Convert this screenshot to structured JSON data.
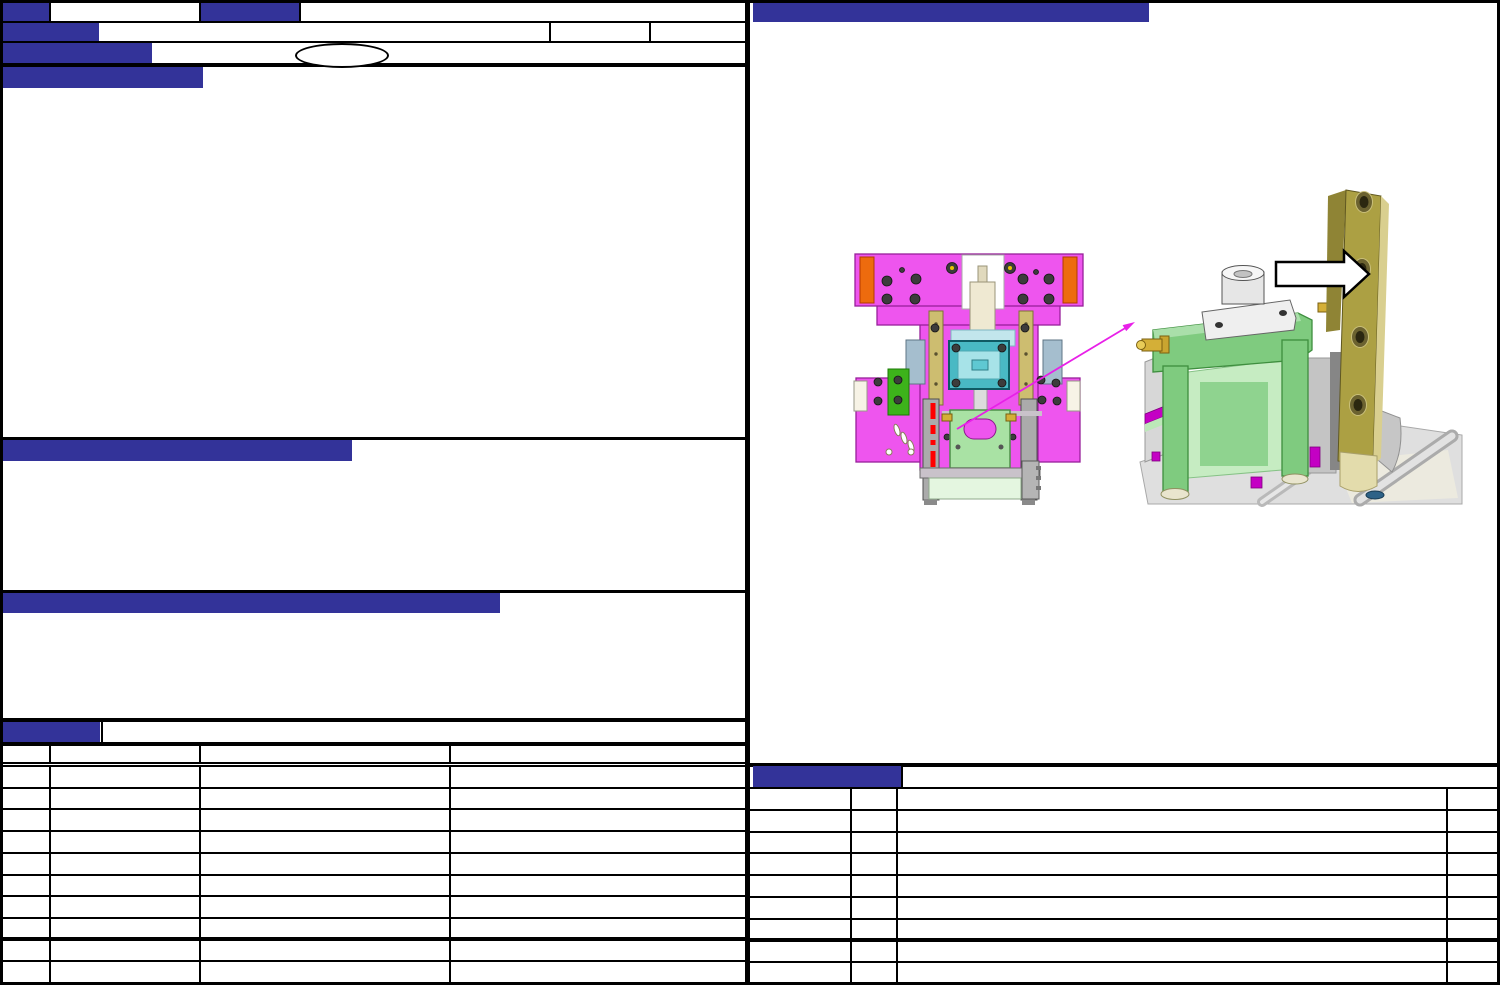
{
  "colors": {
    "accent": "#333399",
    "line": "#000000",
    "bg": "#ffffff",
    "fig-pink": "#ee55ee",
    "fig-orange": "#ed6b0e",
    "fig-tan": "#cdbd70",
    "fig-cyan": "#49b9c4",
    "fig-cyan-light": "#a7e3e8",
    "fig-green-bright": "#3db31b",
    "fig-green": "#7fcb7f",
    "fig-green-light": "#a9e2a4",
    "fig-green-pale": "#e4f6e0",
    "fig-khaki": "#aca043",
    "fig-khaki-light": "#d9cf8f",
    "fig-khaki-dark": "#8f8435",
    "fig-gray": "#ababab",
    "fig-base-gray": "#dfdfdf",
    "fig-ivory": "#efe9d2",
    "fig-gold": "#d4af37",
    "fig-red": "#ff0000",
    "fig-magenta": "#c400c4",
    "fig-leader": "#e820e8",
    "fig-hole-blue": "#2e6287"
  },
  "header": {
    "badge_row1_left": "",
    "cell_row1_a": "",
    "badge_row1_mid": "",
    "cell_row1_b": "",
    "badge_row2": "",
    "cell_row2_a": "",
    "cell_row2_b": "",
    "cell_row2_c": "",
    "badge_row3": "",
    "cell_row3": "",
    "oval_label": "",
    "section1_title": ""
  },
  "sections": {
    "section1_content": "",
    "section2_title": "",
    "section2_content": "",
    "section3_title": "",
    "section3_content": ""
  },
  "left_table": {
    "title_badge": "",
    "title": "",
    "columns": [
      "",
      "",
      "",
      ""
    ],
    "rows": [
      [
        "",
        "",
        "",
        ""
      ],
      [
        "",
        "",
        "",
        ""
      ],
      [
        "",
        "",
        "",
        ""
      ],
      [
        "",
        "",
        "",
        ""
      ],
      [
        "",
        "",
        "",
        ""
      ],
      [
        "",
        "",
        "",
        ""
      ],
      [
        "",
        "",
        "",
        ""
      ],
      [
        "",
        "",
        "",
        ""
      ],
      [
        "",
        "",
        "",
        ""
      ],
      [
        "",
        "",
        "",
        ""
      ]
    ]
  },
  "right_panel": {
    "top_bar_title": ""
  },
  "right_table": {
    "title_badge": "",
    "title": "",
    "columns": [
      "",
      "",
      "",
      ""
    ],
    "rows": [
      [
        "",
        "",
        "",
        ""
      ],
      [
        "",
        "",
        "",
        ""
      ],
      [
        "",
        "",
        "",
        ""
      ],
      [
        "",
        "",
        "",
        ""
      ],
      [
        "",
        "",
        "",
        ""
      ],
      [
        "",
        "",
        "",
        ""
      ],
      [
        "",
        "",
        "",
        ""
      ],
      [
        "",
        "",
        "",
        ""
      ]
    ]
  },
  "figures": {
    "overview_view": {
      "name": "mold-assembly-front-view",
      "parts": [
        {
          "name": "mold-plate",
          "color": "#ee55ee"
        },
        {
          "name": "corner-wear-strips",
          "color": "#ed6b0e"
        },
        {
          "name": "guide-bars",
          "color": "#cdbd70"
        },
        {
          "name": "center-cavity-block",
          "color": "#49b9c4"
        },
        {
          "name": "side-block",
          "color": "#3db31b"
        },
        {
          "name": "lower-insert",
          "color": "#a9e2a4"
        },
        {
          "name": "highlight-dashed-line",
          "color": "#ff0000"
        }
      ]
    },
    "detail_view": {
      "name": "clamp-detail-view",
      "parts": [
        {
          "name": "clamp-bracket",
          "color": "#7fcb7f"
        },
        {
          "name": "cylinder-boss",
          "color": "#e6e6e6"
        },
        {
          "name": "hose-nipple",
          "color": "#d4af37"
        },
        {
          "name": "locating-bar",
          "color": "#aca043"
        },
        {
          "name": "base-plate",
          "color": "#dfdfdf"
        },
        {
          "name": "direction-arrow",
          "color": "#ffffff"
        }
      ]
    }
  }
}
